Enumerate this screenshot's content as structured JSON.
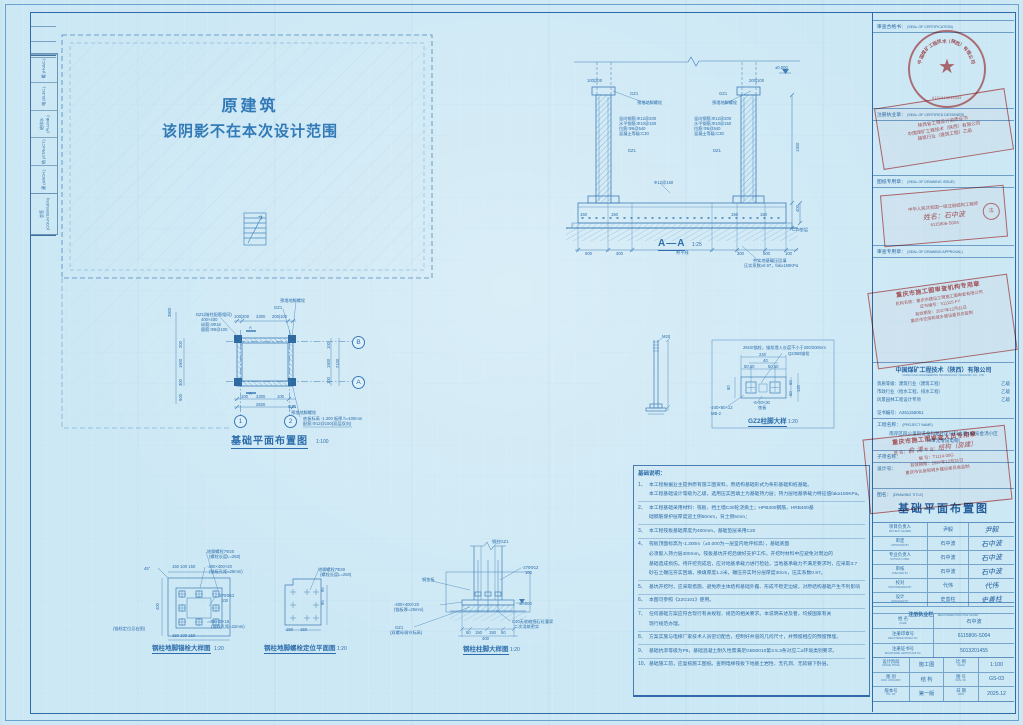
{
  "shadow_area": {
    "line1": "原建筑",
    "line2": "该阴影不在本次设计范围"
  },
  "signoff": {
    "header": "会签 (COUNTERSIGN)",
    "rows": [
      "建 (ARCH.)",
      "结 (STRUCT.)",
      "给排水 (PLUMB.)",
      "电 (ELEC.)",
      "暖 (HVAC.)"
    ]
  },
  "notes": {
    "header": "基础说明：",
    "items": [
      {
        "num": "1、",
        "lines": [
          "本工程根据业主提供原有施工图资料，原结构基础形式为条形基础和桩基础。",
          "本工程基础设计等级为乙级，选用压实回填土为基础持力层；持力层地基承载力特征值fak≥150KPa。"
        ]
      },
      {
        "num": "2、",
        "lines": [
          "本工程基础采用材料：筏板、挡土墙C30砼浇捣土；HPB300钢筋，HRB400基",
          "础钢筋保护层厚度迎土侧50mm，背土侧5mm；"
        ]
      },
      {
        "num": "3、",
        "lines": [
          "本工程筏板基础厚度为400mm，基础垫层采用C20"
        ]
      },
      {
        "num": "4、",
        "lines": [
          "筏板顶面标高为-1.300m（±0.000为一层室内地坪标高），基础底面",
          "必须嵌入持力层300mm。筏板基坑开挖后做好支护工作，开挖时材料中应避免对周边的",
          "基础造成损伤。待开挖完成后，应对地基承载力进行检验，当地基承载力不满足要求时，应采取3:7",
          "砂石土碾压夯实回填，换填厚度1.2米，碾压夯实时分层厚度30cm，压实系数0.97。"
        ]
      },
      {
        "num": "5、",
        "lines": [
          "基坑开挖时，应采取措施，避免原主体结构基础外露、形成不稳定边坡，对原结构基础产生不利影响"
        ]
      },
      {
        "num": "6、",
        "lines": [
          "本图可参照《22G101》使用。"
        ]
      },
      {
        "num": "7、",
        "lines": [
          "任何基础方案应符合现行有关规程、规范的相关要求。本说明未述及者，均按国家有关",
          "现行规范办理。"
        ]
      },
      {
        "num": "8、",
        "lines": [
          "方案实施与电梯厂家技术人员密切配合，控制好井道的几何尺寸，并预留相应的预留预埋。"
        ]
      },
      {
        "num": "9、",
        "lines": [
          "基础抗渗等级为P8，基础混凝土耐久性需满足GB50010第3.5.3条对应二a环境类别要求。"
        ]
      },
      {
        "num": "10、",
        "lines": [
          "基础施工前，应复核施工图纸。查明电梯筏板下地基土岩性、无孔洞、无软弱下卧层。"
        ]
      }
    ]
  },
  "titleblock": {
    "seal_rows": [
      {
        "cn": "审查合格书：",
        "en": "(SEAL OF CERTIFICATION)"
      },
      {
        "cn": "注册执业章：",
        "en": "(SEAL OF CERTIFIED DESIGNER)"
      },
      {
        "cn": "图纸专用章：",
        "en": "(SEAL OF DRAWING ISSUE)"
      },
      {
        "cn": "审查专用章：",
        "en": "(SEAL OF DRAWING APPROVAL)"
      }
    ],
    "company": {
      "cn": "中国煤矿工程技术（陕西）有限公司",
      "en": "CHINA COAL ENGINEERING TECHNOLOGY (SHAANXI) CO., LTD."
    },
    "quals": {
      "label": "资质等级：",
      "rows": [
        {
          "item": "建筑行业（建筑工程）",
          "grade": "乙级"
        },
        {
          "item": "市政行业（给水工程、排水工程）",
          "grade": "乙级"
        },
        {
          "item": "风景园林工程设计专项",
          "grade": "乙级"
        }
      ],
      "cert_label": "证书编号：",
      "cert_no": "A261155061"
    },
    "project": {
      "label": "工程名称：",
      "en": "(PROJECT NAME)",
      "line1": "南岸区四公里街道金科路社区兴科大道180号金汤小区",
      "line2": "（3单元增设电梯）"
    },
    "subitem_label": "子项名称：",
    "design_no_label": "设计号：",
    "drawing": {
      "label": "图名：",
      "en": "(DRAWING TITLE)",
      "title": "基础平面布置图"
    },
    "signatures": [
      {
        "role": "项目负责人",
        "role_en": "PROJECT LEADER",
        "name": "尹毅",
        "sig": "尹毅"
      },
      {
        "role": "审定",
        "role_en": "APPROVED BY",
        "name": "石中波",
        "sig": "石中波"
      },
      {
        "role": "专业负责人",
        "role_en": "DIVISION CHIEF",
        "name": "石中波",
        "sig": "石中波"
      },
      {
        "role": "审核",
        "role_en": "CHECKED BY",
        "name": "石中波",
        "sig": "石中波"
      },
      {
        "role": "校对",
        "role_en": "PROOFREADED BY",
        "name": "代伟",
        "sig": "代伟"
      },
      {
        "role": "设计",
        "role_en": "DESIGNED BY",
        "name": "史善柱",
        "sig": "史善柱"
      }
    ],
    "registered": {
      "header": "注册执业栏",
      "header_en": "REGISTERED PRACTICE SIGNET",
      "rows": [
        {
          "label": "姓 名",
          "label_en": "NAME",
          "value": "石中波"
        },
        {
          "label": "注册印章号",
          "label_en": "REGISTERED SIGNET NO.",
          "value": "6115806-S004"
        },
        {
          "label": "注册证书号",
          "label_en": "REGISTERED CERTIFICATE NO.",
          "value": "5013201455"
        }
      ]
    },
    "meta_rows": [
      {
        "l1": "设计阶段",
        "l1en": "DESIGN PHASE",
        "v1": "施工图",
        "l2": "比 例",
        "l2en": "SCALE",
        "v2": "1:100"
      },
      {
        "l1": "图 别",
        "l1en": "DWG. CATEGORY",
        "v1": "结 构",
        "l2": "图 号",
        "l2en": "DWG. NO.",
        "v2": "GS-03"
      },
      {
        "l1": "版本号",
        "l1en": "VOL. NO.",
        "v1": "第一版",
        "l2": "日 期",
        "l2en": "DATE",
        "v2": "2025.12"
      }
    ]
  },
  "stamps": {
    "round_seal": {
      "company": "中国煤矿工程技术（陕西）有限公司",
      "star": "★",
      "number": "6101910236559"
    },
    "designer_seal": {
      "lines": [
        "陕西省工程设计资质证书",
        "中国煤矿工程技术（陕西）有限公司",
        "建筑行业（建筑工程）乙级"
      ]
    },
    "engineer_seal": {
      "line1": "中华人民共和国一级注册结构工程师",
      "name": "姓名：石中波",
      "no": "6115806-S004",
      "sub": "注"
    },
    "agency_seal": {
      "title": "重庆市施工图审查机构专用章",
      "lines": [
        "机构名称：重庆市建设工程施工图审查有限公司",
        "证书编号：511115-FY",
        "有效期至：2027年12月31日",
        "重庆市住房和城乡建设委员会监制"
      ]
    },
    "reviewer_seal": {
      "title": "重庆市施工图审查人员专用章",
      "name_label": "姓 名：",
      "name": "俞 涛",
      "major_label": "专 业：",
      "major": "结构（房建）",
      "no_line": "编 号：T1114-00G",
      "valid": "有效期限：2027年12月31日",
      "footer": "重庆市住房和城乡建设委员会监制"
    }
  },
  "annotations": [
    {
      "n": "dim-label",
      "t": "100|200",
      "x": 587,
      "y": 79,
      "c": "dim"
    },
    {
      "n": "dim-label",
      "t": "200|100",
      "x": 749,
      "y": 79,
      "c": "dim"
    },
    {
      "n": "column-label",
      "t": "GZ1",
      "x": 630,
      "y": 92,
      "c": "dim"
    },
    {
      "n": "column-label",
      "t": "GZ1",
      "x": 719,
      "y": 92,
      "c": "dim"
    },
    {
      "n": "bolt-label",
      "t": "预埋地脚螺栓",
      "x": 637,
      "y": 101,
      "c": "dim"
    },
    {
      "n": "bolt-label",
      "t": "预埋地脚螺栓",
      "x": 712,
      "y": 101,
      "c": "dim"
    },
    {
      "n": "rebar-label",
      "t": "竖向钢筋:Φ12@200",
      "x": 619,
      "y": 117,
      "c": "dim"
    },
    {
      "n": "rebar-label",
      "t": "水平钢筋:Φ10@150",
      "x": 619,
      "y": 122,
      "c": "dim"
    },
    {
      "n": "rebar-label",
      "t": "拉筋:Φ6@540",
      "x": 619,
      "y": 127,
      "c": "dim"
    },
    {
      "n": "rebar-label",
      "t": "混凝土等级:C30",
      "x": 619,
      "y": 132,
      "c": "dim"
    },
    {
      "n": "rebar-label",
      "t": "竖向钢筋:Φ12@200",
      "x": 694,
      "y": 117,
      "c": "dim"
    },
    {
      "n": "rebar-label",
      "t": "水平钢筋:Φ10@150",
      "x": 694,
      "y": 122,
      "c": "dim"
    },
    {
      "n": "rebar-label",
      "t": "拉筋:Φ6@540",
      "x": 694,
      "y": 127,
      "c": "dim"
    },
    {
      "n": "rebar-label",
      "t": "混凝土等级:C30",
      "x": 694,
      "y": 132,
      "c": "dim"
    },
    {
      "n": "column-label",
      "t": "DZ1",
      "x": 628,
      "y": 149,
      "c": "dim"
    },
    {
      "n": "column-label",
      "t": "DZ1",
      "x": 713,
      "y": 149,
      "c": "dim"
    },
    {
      "n": "rebar-label",
      "t": "Φ12@150",
      "x": 654,
      "y": 181,
      "c": "dim"
    },
    {
      "n": "dim-label",
      "t": "150",
      "x": 580,
      "y": 213,
      "c": "dim"
    },
    {
      "n": "dim-label",
      "t": "150",
      "x": 611,
      "y": 213,
      "c": "dim"
    },
    {
      "n": "dim-label",
      "t": "150",
      "x": 731,
      "y": 213,
      "c": "dim"
    },
    {
      "n": "dim-label",
      "t": "150",
      "x": 760,
      "y": 213,
      "c": "dim"
    },
    {
      "n": "dim-label",
      "t": "400",
      "x": 796,
      "y": 212,
      "c": "dim",
      "r": -90
    },
    {
      "n": "dim-label",
      "t": "1300",
      "x": 796,
      "y": 152,
      "c": "dim",
      "r": -90
    },
    {
      "n": "level-label",
      "t": "±0.000",
      "x": 775,
      "y": 66,
      "c": "dim"
    },
    {
      "n": "dim-label",
      "t": "500",
      "x": 585,
      "y": 252,
      "c": "dim"
    },
    {
      "n": "dim-label",
      "t": "300",
      "x": 616,
      "y": 252,
      "c": "dim"
    },
    {
      "n": "label",
      "t": "夯平线",
      "x": 676,
      "y": 251,
      "c": "dim"
    },
    {
      "n": "dim-label",
      "t": "300",
      "x": 737,
      "y": 252,
      "c": "dim"
    },
    {
      "n": "dim-label",
      "t": "500",
      "x": 763,
      "y": 252,
      "c": "dim"
    },
    {
      "n": "dim-label",
      "t": "100",
      "x": 785,
      "y": 252,
      "c": "dim"
    },
    {
      "n": "label",
      "t": "C15垫层",
      "x": 792,
      "y": 228,
      "c": "dim"
    },
    {
      "n": "label",
      "t": "夯实地基碾压回填",
      "x": 753,
      "y": 259,
      "c": "dim"
    },
    {
      "n": "label",
      "t": "压实系数≥0.97，fak≥150KPa",
      "x": 744,
      "y": 264,
      "c": "dim"
    },
    {
      "n": "section-title",
      "t": "A—A",
      "x": 658,
      "y": 238,
      "c": "stitle"
    },
    {
      "n": "scale-label",
      "t": "1:25",
      "x": 692,
      "y": 243,
      "c": "scale"
    },
    {
      "n": "dim-label",
      "t": "3800",
      "x": 168,
      "y": 317,
      "c": "dim",
      "r": -90
    },
    {
      "n": "dim-label",
      "t": "200",
      "x": 179,
      "y": 348,
      "c": "dim",
      "r": -90
    },
    {
      "n": "dim-label",
      "t": "1900",
      "x": 179,
      "y": 368,
      "c": "dim",
      "r": -90
    },
    {
      "n": "dim-label",
      "t": "300",
      "x": 179,
      "y": 386,
      "c": "dim",
      "r": -90
    },
    {
      "n": "dim-label",
      "t": "500",
      "x": 179,
      "y": 401,
      "c": "dim",
      "r": -90
    },
    {
      "n": "bolt-label",
      "t": "预埋地脚螺栓",
      "x": 280,
      "y": 299,
      "c": "dim"
    },
    {
      "n": "column-label",
      "t": "GZ1",
      "x": 274,
      "y": 306,
      "c": "dim"
    },
    {
      "n": "column-label",
      "t": "DZ1(暗柱配筋相同)",
      "x": 196,
      "y": 313,
      "c": "dim"
    },
    {
      "n": "column-label",
      "t": "400×400",
      "x": 201,
      "y": 318,
      "c": "dim"
    },
    {
      "n": "rebar-label",
      "t": "纵筋:4Φ16",
      "x": 201,
      "y": 323,
      "c": "dim"
    },
    {
      "n": "rebar-label",
      "t": "箍筋:Φ8@100",
      "x": 201,
      "y": 328,
      "c": "dim"
    },
    {
      "n": "dim-label",
      "t": "100|200",
      "x": 234,
      "y": 315,
      "c": "dim"
    },
    {
      "n": "dim-label",
      "t": "2300",
      "x": 256,
      "y": 315,
      "c": "dim"
    },
    {
      "n": "dim-label",
      "t": "200|100",
      "x": 272,
      "y": 315,
      "c": "dim"
    },
    {
      "n": "cut-label",
      "t": "A",
      "x": 249,
      "y": 326,
      "c": "dim"
    },
    {
      "n": "cut-label",
      "t": "A",
      "x": 249,
      "y": 392,
      "c": "dim"
    },
    {
      "n": "dim-label",
      "t": "100",
      "x": 327,
      "y": 349,
      "c": "dim",
      "r": -90
    },
    {
      "n": "dim-label",
      "t": "1900",
      "x": 327,
      "y": 368,
      "c": "dim",
      "r": -90
    },
    {
      "n": "dim-label",
      "t": "2100",
      "x": 336,
      "y": 368,
      "c": "dim",
      "r": -90
    },
    {
      "n": "dim-label",
      "t": "100",
      "x": 327,
      "y": 384,
      "c": "dim",
      "r": -90
    },
    {
      "n": "dim-label",
      "t": "100",
      "x": 241,
      "y": 395,
      "c": "dim"
    },
    {
      "n": "dim-label",
      "t": "2300",
      "x": 256,
      "y": 395,
      "c": "dim"
    },
    {
      "n": "dim-label",
      "t": "100",
      "x": 277,
      "y": 395,
      "c": "dim"
    },
    {
      "n": "dim-label",
      "t": "2500",
      "x": 256,
      "y": 403,
      "c": "dim"
    },
    {
      "n": "column-label",
      "t": "GZ1",
      "x": 288,
      "y": 405,
      "c": "dim"
    },
    {
      "n": "bolt-label",
      "t": "预埋地脚螺栓",
      "x": 291,
      "y": 411,
      "c": "dim"
    },
    {
      "n": "note-label",
      "t": "底板标高 -1.300  板厚 h=400mm",
      "x": 303,
      "y": 417,
      "c": "dim"
    },
    {
      "n": "note-label",
      "t": "配筋:Φ12@150(双层双向)",
      "x": 303,
      "y": 422,
      "c": "dim"
    },
    {
      "n": "grid-bubble",
      "t": "B",
      "x": 352,
      "y": 336,
      "c": "bubble"
    },
    {
      "n": "grid-bubble",
      "t": "A",
      "x": 352,
      "y": 376,
      "c": "bubble"
    },
    {
      "n": "grid-bubble",
      "t": "1",
      "x": 234,
      "y": 415,
      "c": "bubble"
    },
    {
      "n": "grid-bubble",
      "t": "2",
      "x": 284,
      "y": 415,
      "c": "bubble"
    },
    {
      "n": "plan-title",
      "t": "基础平面布置图",
      "x": 231,
      "y": 436,
      "c": "stitle"
    },
    {
      "n": "scale-label",
      "t": "1:100",
      "x": 316,
      "y": 440,
      "c": "scale"
    },
    {
      "n": "bolt-label",
      "t": "M20",
      "x": 662,
      "y": 335,
      "c": "dim"
    },
    {
      "n": "note-label",
      "t": "2M10锚栓，锚栓埋入长度不小于200/200mm",
      "x": 743,
      "y": 346,
      "c": "dim"
    },
    {
      "n": "note-label",
      "t": "Q235B锚栓",
      "x": 788,
      "y": 352,
      "c": "dim"
    },
    {
      "n": "dim-label",
      "t": "240",
      "x": 759,
      "y": 353,
      "c": "dim"
    },
    {
      "n": "dim-label",
      "t": "40",
      "x": 763,
      "y": 359,
      "c": "dim"
    },
    {
      "n": "dim-label",
      "t": "50,50",
      "x": 744,
      "y": 365,
      "c": "dim"
    },
    {
      "n": "dim-label",
      "t": "50,50",
      "x": 768,
      "y": 365,
      "c": "dim"
    },
    {
      "n": "dim-label",
      "t": "80",
      "x": 727,
      "y": 390,
      "c": "dim",
      "r": -90
    },
    {
      "n": "dim-label",
      "t": "60",
      "x": 789,
      "y": 385,
      "c": "dim",
      "r": -90
    },
    {
      "n": "dim-label",
      "t": "60",
      "x": 789,
      "y": 396,
      "c": "dim",
      "r": -90
    },
    {
      "n": "dim-label",
      "t": "120",
      "x": 797,
      "y": 392,
      "c": "dim",
      "r": -90
    },
    {
      "n": "plate-label",
      "t": "-6-30×30",
      "x": 753,
      "y": 401,
      "c": "dim"
    },
    {
      "n": "plate-label",
      "t": "垫板",
      "x": 758,
      "y": 406,
      "c": "dim"
    },
    {
      "n": "plate-label",
      "t": "-240×80×12",
      "x": 710,
      "y": 406,
      "c": "dim"
    },
    {
      "n": "plate-label",
      "t": "MB-2",
      "x": 711,
      "y": 412,
      "c": "dim"
    },
    {
      "n": "detail-title",
      "t": "GZ2柱脚大样",
      "x": 748,
      "y": 418,
      "c": "dtitle"
    },
    {
      "n": "scale-label",
      "t": "1:20",
      "x": 788,
      "y": 420,
      "c": "scale"
    },
    {
      "n": "bolt-label",
      "t": "地脚螺栓7Φ20",
      "x": 207,
      "y": 550,
      "c": "dim"
    },
    {
      "n": "bolt-label",
      "t": "(螺栓长度L=250)",
      "x": 209,
      "y": 555,
      "c": "dim"
    },
    {
      "n": "plate-label",
      "t": "-400×400×20",
      "x": 207,
      "y": 565,
      "c": "dim"
    },
    {
      "n": "plate-label",
      "t": "(锚板孔距=25mm)",
      "x": 209,
      "y": 570,
      "c": "dim"
    },
    {
      "n": "rebar-label",
      "t": "-270Φ12",
      "x": 218,
      "y": 594,
      "c": "dim"
    },
    {
      "n": "rebar-label",
      "t": "100",
      "x": 221,
      "y": 599,
      "c": "dim"
    },
    {
      "n": "plate-label",
      "t": "-70×70×16",
      "x": 209,
      "y": 620,
      "c": "dim"
    },
    {
      "n": "plate-label",
      "t": "(锚栓孔距=22mm)",
      "x": 211,
      "y": 625,
      "c": "dim"
    },
    {
      "n": "note-label",
      "t": "(锚栓定位见右图)",
      "x": 113,
      "y": 627,
      "c": "dim"
    },
    {
      "n": "dim-label",
      "t": "45°",
      "x": 144,
      "y": 567,
      "c": "dim"
    },
    {
      "n": "dim-label",
      "t": "150 100 150",
      "x": 172,
      "y": 565,
      "c": "dim"
    },
    {
      "n": "dim-label",
      "t": "150 100 150",
      "x": 172,
      "y": 634,
      "c": "dim"
    },
    {
      "n": "dim-label",
      "t": "400",
      "x": 156,
      "y": 610,
      "c": "dim",
      "r": -90
    },
    {
      "n": "detail-title",
      "t": "钢柱地脚锚栓大样图",
      "x": 152,
      "y": 645,
      "c": "dtitle"
    },
    {
      "n": "scale-label",
      "t": "1:20",
      "x": 214,
      "y": 647,
      "c": "scale"
    },
    {
      "n": "bolt-label",
      "t": "地脚螺栓7Φ20",
      "x": 318,
      "y": 568,
      "c": "dim"
    },
    {
      "n": "bolt-label",
      "t": "(螺栓长度L=250)",
      "x": 320,
      "y": 573,
      "c": "dim"
    },
    {
      "n": "dim-label",
      "t": "150",
      "x": 286,
      "y": 628,
      "c": "dim"
    },
    {
      "n": "dim-label",
      "t": "150",
      "x": 300,
      "y": 628,
      "c": "dim"
    },
    {
      "n": "dim-label",
      "t": "95",
      "x": 321,
      "y": 592,
      "c": "dim",
      "r": -90
    },
    {
      "n": "dim-label",
      "t": "95",
      "x": 321,
      "y": 605,
      "c": "dim",
      "r": -90
    },
    {
      "n": "detail-title",
      "t": "钢柱地脚螺栓定位平面图",
      "x": 264,
      "y": 645,
      "c": "dtitle"
    },
    {
      "n": "scale-label",
      "t": "1:20",
      "x": 337,
      "y": 647,
      "c": "scale"
    },
    {
      "n": "column-label",
      "t": "钢柱GZ1",
      "x": 492,
      "y": 540,
      "c": "dim"
    },
    {
      "n": "rebar-label",
      "t": "-270Φ12",
      "x": 522,
      "y": 566,
      "c": "dim"
    },
    {
      "n": "rebar-label",
      "t": "100",
      "x": 525,
      "y": 571,
      "c": "dim"
    },
    {
      "n": "plate-label",
      "t": "钢垫板",
      "x": 422,
      "y": 578,
      "c": "dim"
    },
    {
      "n": "plate-label",
      "t": "-400×400×20",
      "x": 394,
      "y": 603,
      "c": "dim"
    },
    {
      "n": "plate-label",
      "t": "(锚板厚=25mm)",
      "x": 394,
      "y": 608,
      "c": "dim"
    },
    {
      "n": "level-label",
      "t": "±0.000",
      "x": 519,
      "y": 602,
      "c": "dim"
    },
    {
      "n": "note-label",
      "t": "C40无收缩细石砼灌浆",
      "x": 512,
      "y": 620,
      "c": "dim"
    },
    {
      "n": "note-label",
      "t": "二次浇筑密实",
      "x": 514,
      "y": 625,
      "c": "dim"
    },
    {
      "n": "column-label",
      "t": "GZ1",
      "x": 395,
      "y": 626,
      "c": "dim"
    },
    {
      "n": "note-label",
      "t": "(双螺母调节标高)",
      "x": 390,
      "y": 631,
      "c": "dim"
    },
    {
      "n": "dim-label",
      "t": "50",
      "x": 466,
      "y": 631,
      "c": "dim"
    },
    {
      "n": "dim-label",
      "t": "150",
      "x": 475,
      "y": 631,
      "c": "dim"
    },
    {
      "n": "dim-label",
      "t": "150",
      "x": 489,
      "y": 631,
      "c": "dim"
    },
    {
      "n": "dim-label",
      "t": "50",
      "x": 501,
      "y": 631,
      "c": "dim"
    },
    {
      "n": "dim-label",
      "t": "400",
      "x": 482,
      "y": 637,
      "c": "dim"
    },
    {
      "n": "detail-title",
      "t": "钢柱柱脚大样图",
      "x": 463,
      "y": 646,
      "c": "dtitle"
    },
    {
      "n": "scale-label",
      "t": "1:20",
      "x": 510,
      "y": 648,
      "c": "scale"
    }
  ]
}
